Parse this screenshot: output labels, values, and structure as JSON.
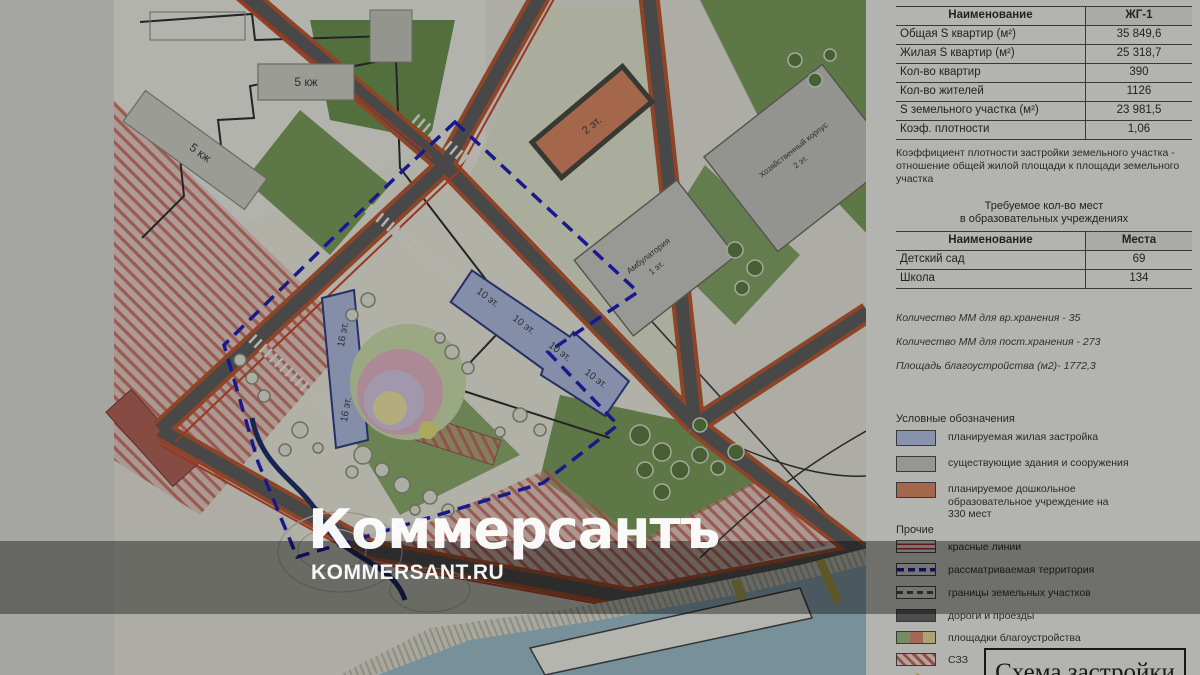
{
  "watermark": {
    "logo": "Коммерсантъ",
    "site": "KOMMERSANT.RU"
  },
  "map": {
    "labels": {
      "k5a": "5 кж",
      "k5b": "5 кж",
      "kg": "2 эт.",
      "b16": "16 эт.",
      "b10": "10 эт.",
      "hoz1": "Хозяйственный корпус",
      "hoz2": "2 эт.",
      "amb1": "Амбулатория",
      "amb2": "1 эт."
    }
  },
  "panel": {
    "table1": {
      "header": {
        "name": "Наименование",
        "value": "ЖГ-1"
      },
      "rows": [
        {
          "label": "Общая S квартир (м²)",
          "value": "35 849,6"
        },
        {
          "label": "Жилая S квартир (м²)",
          "value": "25 318,7"
        },
        {
          "label": "Кол-во квартир",
          "value": "390"
        },
        {
          "label": "Кол-во жителей",
          "value": "1126"
        },
        {
          "label": "S земельного участка (м²)",
          "value": "23 981,5"
        },
        {
          "label": "Коэф. плотности",
          "value": "1,06"
        }
      ]
    },
    "density_note": "Коэффициент плотности застройки земельного участка - отношение общей жилой площади к площади земельного участка",
    "edu_heading_line1": "Требуемое кол-во мест",
    "edu_heading_line2": "в образовательных учреждениях",
    "table2": {
      "header": {
        "name": "Наименование",
        "value": "Места"
      },
      "rows": [
        {
          "label": "Детский сад",
          "value": "69"
        },
        {
          "label": "Школа",
          "value": "134"
        }
      ]
    },
    "notes": [
      "Количество ММ для вр.хранения - 35",
      "Количество ММ для пост.хранения - 273",
      "Площадь благоустройства (м2)- 1772,3"
    ],
    "legend": {
      "title": "Условные обозначения",
      "items": [
        {
          "label": "планируемая жилая застройка",
          "color": "#b8c4e8"
        },
        {
          "label": "существующие здания и сооружения",
          "color": "#c9c9c4"
        },
        {
          "label": "планируемое дошкольное образовательное учреждение на 330 мест",
          "color": "#dd8a64"
        }
      ],
      "other_title": "Прочие",
      "other_items": [
        "красные линии",
        "рассматриваемая территория",
        "границы земельных участков",
        "дороги и проезды",
        "площадки благоустройства",
        "СЗЗ"
      ]
    },
    "title_box": "Схема застройки"
  }
}
